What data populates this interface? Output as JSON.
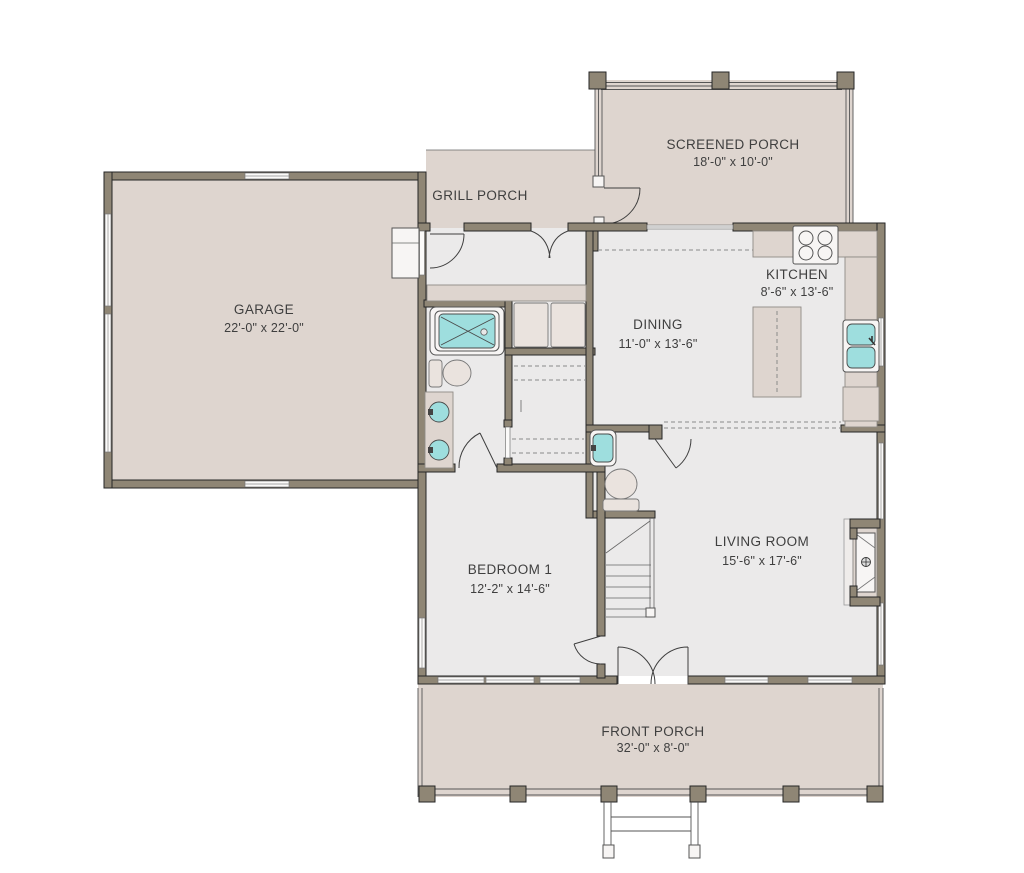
{
  "plan": {
    "title": "First floor plan",
    "rooms": [
      {
        "id": "garage",
        "name": "GARAGE",
        "dims": "22'-0\" x 22'-0\""
      },
      {
        "id": "grill-porch",
        "name": "GRILL PORCH",
        "dims": ""
      },
      {
        "id": "screened-porch",
        "name": "SCREENED PORCH",
        "dims": "18'-0\" x 10'-0\""
      },
      {
        "id": "kitchen",
        "name": "KITCHEN",
        "dims": "8'-6\" x 13'-6\""
      },
      {
        "id": "dining",
        "name": "DINING",
        "dims": "11'-0\" x 13'-6\""
      },
      {
        "id": "living-room",
        "name": "LIVING ROOM",
        "dims": "15'-6\" x 17'-6\""
      },
      {
        "id": "bedroom-1",
        "name": "BEDROOM 1",
        "dims": "12'-2\" x 14'-6\""
      },
      {
        "id": "front-porch",
        "name": "FRONT PORCH",
        "dims": "32'-0\" x 8'-0\""
      }
    ],
    "colors": {
      "wall": "#8f8675",
      "line": "#262626",
      "floor": "#ebeaea",
      "porch": "#ded5cf",
      "teal": "#9edede",
      "fixture": "#f7f5f4",
      "text": "#3f3f3f"
    }
  }
}
